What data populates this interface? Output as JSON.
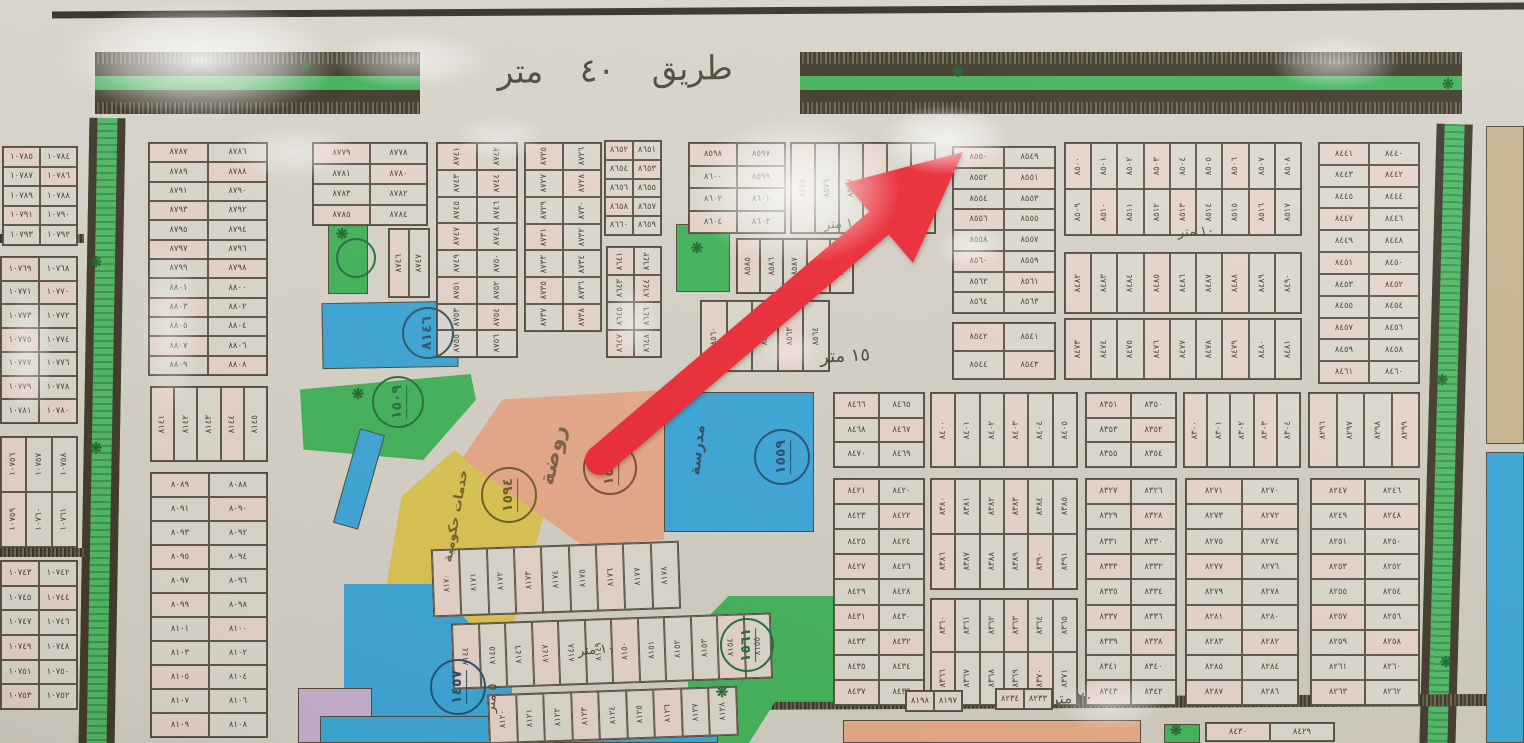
{
  "numerals": "٠١٢٣٤٥٦٧٨٩",
  "colors": {
    "green": "#3cb257",
    "blue": "#35a5da",
    "yellow": "#dcc44e",
    "salmon": "#e7a887",
    "lavender": "#c5afd2",
    "tan": "#c6b28c",
    "arrow_red": "#ee2431",
    "ink": "#4a4335",
    "paper": "#d7d3ca"
  },
  "roads": {
    "top_label": "طريق ٤٠ متر"
  },
  "street_labels": [
    {
      "text": "١٥ متر",
      "x": 845,
      "y": 356,
      "size": 18,
      "rot": -3
    },
    {
      "text": "١٠ متر",
      "x": 842,
      "y": 224,
      "size": 13,
      "rot": -4
    },
    {
      "text": "١٠ متر",
      "x": 652,
      "y": 422,
      "size": 13,
      "rot": -8
    },
    {
      "text": "١٠ متر",
      "x": 596,
      "y": 650,
      "size": 13,
      "rot": -5
    },
    {
      "text": "١٠ متر",
      "x": 1196,
      "y": 232,
      "size": 13,
      "rot": -3
    },
    {
      "text": "٢٠ متر",
      "x": 1072,
      "y": 698,
      "size": 15,
      "rot": -3
    },
    {
      "text": "٥ متر",
      "x": 492,
      "y": 698,
      "size": 13,
      "rot": -85
    }
  ],
  "zone_labels": [
    {
      "text": "روضة",
      "x": 553,
      "y": 455,
      "rot": -78,
      "size": 22,
      "color": "#6b5138"
    },
    {
      "text": "مدرسة",
      "x": 697,
      "y": 450,
      "rot": -84,
      "size": 15,
      "color": "#2a3c48"
    },
    {
      "text": "خدمات حكومية",
      "x": 456,
      "y": 516,
      "rot": -80,
      "size": 13,
      "color": "#5d4c28"
    }
  ],
  "zones": [
    {
      "id": "garden-small-left",
      "color": "green",
      "x": 328,
      "y": 224,
      "w": 40,
      "h": 70
    },
    {
      "id": "school-strip-left",
      "color": "blue",
      "x": 322,
      "y": 302,
      "w": 136,
      "h": 66,
      "rot": -1
    },
    {
      "id": "garden-triangle",
      "color": "green",
      "x": 300,
      "y": 374,
      "w": 176,
      "h": 86,
      "clip": "polygon(0 18%,97% 0,100% 30%,70% 100%,2% 88%)"
    },
    {
      "id": "blue-sliver",
      "color": "blue",
      "x": 346,
      "y": 430,
      "w": 26,
      "h": 98,
      "rot": 16
    },
    {
      "id": "services-yellow",
      "color": "yellow",
      "x": 384,
      "y": 450,
      "w": 160,
      "h": 272,
      "clip": "polygon(44% 0,100% 24%,83% 60%,52% 100%,17% 92%,0 55%,11% 17%)"
    },
    {
      "id": "kindergarten",
      "color": "salmon",
      "x": 462,
      "y": 390,
      "w": 202,
      "h": 156,
      "clip": "polygon(20% 6%,100% 0,100% 96%,60% 100%,0 44%)"
    },
    {
      "id": "school-main",
      "color": "blue",
      "x": 664,
      "y": 392,
      "w": 150,
      "h": 140
    },
    {
      "id": "school-lower-left",
      "color": "blue",
      "x": 344,
      "y": 584,
      "w": 168,
      "h": 159,
      "clip": "polygon(0 0,52% 0,100% 52%,100% 100%,28% 100%,0 68%)"
    },
    {
      "id": "lavender-corner",
      "color": "lavender",
      "x": 298,
      "y": 688,
      "w": 74,
      "h": 55
    },
    {
      "id": "garden-mid-bottom",
      "color": "green",
      "x": 688,
      "y": 596,
      "w": 145,
      "h": 147,
      "clip": "polygon(28% 0,100% 0,100% 72%,60% 72%,42% 100%,10% 100%,0 80%,0 28%)"
    },
    {
      "id": "garden-small-top",
      "color": "green",
      "x": 676,
      "y": 224,
      "w": 54,
      "h": 68
    },
    {
      "id": "tan-right-edge",
      "color": "tan",
      "x": 1486,
      "y": 126,
      "w": 38,
      "h": 318
    },
    {
      "id": "blue-right-edge",
      "color": "blue",
      "x": 1486,
      "y": 452,
      "w": 38,
      "h": 291
    },
    {
      "id": "blue-bottom-strip",
      "color": "blue",
      "x": 320,
      "y": 716,
      "w": 398,
      "h": 27
    },
    {
      "id": "salmon-bottom-strip",
      "color": "salmon",
      "x": 843,
      "y": 720,
      "w": 298,
      "h": 23
    },
    {
      "id": "green-bottom-square",
      "color": "green",
      "x": 1164,
      "y": 724,
      "w": 36,
      "h": 19
    }
  ],
  "circles": [
    {
      "value": "٨١٤٦",
      "x": 428,
      "y": 333,
      "d": 52,
      "ink": "#27526b"
    },
    {
      "value": "١٥٠٩",
      "x": 398,
      "y": 402,
      "d": 52,
      "ink": "#1e6b38"
    },
    {
      "value": "١٥٩٤",
      "x": 509,
      "y": 495,
      "d": 56,
      "ink": "#6b5a1e"
    },
    {
      "value": "١٥٥٤",
      "x": 610,
      "y": 468,
      "d": 54,
      "ink": "#7a4a2e"
    },
    {
      "value": "١٥٥٩",
      "x": 782,
      "y": 457,
      "d": 56,
      "ink": "#1d4d72"
    },
    {
      "value": "١٤٥٧",
      "x": 458,
      "y": 687,
      "d": 56,
      "ink": "#1d4d72"
    },
    {
      "value": "١٥٦١",
      "x": 747,
      "y": 645,
      "d": 54,
      "ink": "#1e6b38"
    },
    {
      "value": "",
      "x": 356,
      "y": 258,
      "d": 40,
      "ink": "#1e6b38"
    }
  ],
  "sparkles": [
    {
      "x": 306,
      "y": 66
    },
    {
      "x": 958,
      "y": 72
    },
    {
      "x": 1448,
      "y": 84
    },
    {
      "x": 96,
      "y": 262
    },
    {
      "x": 96,
      "y": 448
    },
    {
      "x": 342,
      "y": 234
    },
    {
      "x": 697,
      "y": 248
    },
    {
      "x": 722,
      "y": 692
    },
    {
      "x": 1442,
      "y": 380
    },
    {
      "x": 1446,
      "y": 662
    },
    {
      "x": 358,
      "y": 394
    },
    {
      "x": 1176,
      "y": 730
    }
  ],
  "blocks": [
    {
      "x": 2,
      "y": 146,
      "w": 76,
      "h": 100,
      "c": 2,
      "r": 5,
      "s": 10784,
      "o": "h"
    },
    {
      "x": 0,
      "y": 256,
      "w": 78,
      "h": 168,
      "c": 2,
      "r": 7,
      "s": 10768,
      "o": "h"
    },
    {
      "x": 0,
      "y": 436,
      "w": 78,
      "h": 112,
      "c": 3,
      "r": 2,
      "s": 10756,
      "o": "v"
    },
    {
      "x": 0,
      "y": 560,
      "w": 78,
      "h": 150,
      "c": 2,
      "r": 6,
      "s": 10742,
      "o": "h"
    },
    {
      "x": 148,
      "y": 142,
      "w": 120,
      "h": 234,
      "c": 2,
      "r": 12,
      "s": 8786,
      "o": "h"
    },
    {
      "x": 150,
      "y": 386,
      "w": 118,
      "h": 76,
      "c": 5,
      "r": 1,
      "s": 8141,
      "o": "v"
    },
    {
      "x": 150,
      "y": 472,
      "w": 118,
      "h": 266,
      "c": 2,
      "r": 11,
      "s": 8088,
      "o": "h"
    },
    {
      "x": 312,
      "y": 142,
      "w": 116,
      "h": 84,
      "c": 2,
      "r": 4,
      "s": 8778,
      "o": "h"
    },
    {
      "x": 388,
      "y": 228,
      "w": 42,
      "h": 70,
      "c": 2,
      "r": 1,
      "s": 8746,
      "o": "v"
    },
    {
      "x": 436,
      "y": 142,
      "w": 82,
      "h": 216,
      "c": 2,
      "r": 8,
      "s": 8741,
      "o": "v"
    },
    {
      "x": 524,
      "y": 142,
      "w": 78,
      "h": 190,
      "c": 2,
      "r": 7,
      "s": 8725,
      "o": "v"
    },
    {
      "x": 604,
      "y": 140,
      "w": 58,
      "h": 96,
      "c": 2,
      "r": 5,
      "s": 8651,
      "o": "h"
    },
    {
      "x": 606,
      "y": 246,
      "w": 56,
      "h": 112,
      "c": 2,
      "r": 4,
      "s": 8641,
      "o": "v"
    },
    {
      "x": 688,
      "y": 142,
      "w": 98,
      "h": 92,
      "c": 2,
      "r": 4,
      "s": 8597,
      "o": "h"
    },
    {
      "x": 736,
      "y": 238,
      "w": 118,
      "h": 56,
      "c": 5,
      "r": 1,
      "s": 8585,
      "o": "v"
    },
    {
      "x": 790,
      "y": 142,
      "w": 146,
      "h": 92,
      "c": 6,
      "r": 1,
      "s": 8575,
      "o": "v"
    },
    {
      "x": 700,
      "y": 300,
      "w": 130,
      "h": 72,
      "c": 5,
      "r": 1,
      "s": 8560,
      "o": "v"
    },
    {
      "x": 952,
      "y": 146,
      "w": 104,
      "h": 168,
      "c": 2,
      "r": 8,
      "s": 8549,
      "o": "h"
    },
    {
      "x": 952,
      "y": 322,
      "w": 104,
      "h": 58,
      "c": 2,
      "r": 2,
      "s": 8541,
      "o": "h"
    },
    {
      "x": 1064,
      "y": 142,
      "w": 238,
      "h": 94,
      "c": 9,
      "r": 2,
      "s": 8500,
      "o": "v"
    },
    {
      "x": 1064,
      "y": 252,
      "w": 238,
      "h": 62,
      "c": 9,
      "r": 1,
      "s": 8482,
      "o": "v"
    },
    {
      "x": 1064,
      "y": 318,
      "w": 238,
      "h": 62,
      "c": 9,
      "r": 1,
      "s": 8473,
      "o": "v"
    },
    {
      "x": 1318,
      "y": 142,
      "w": 102,
      "h": 242,
      "c": 2,
      "r": 11,
      "s": 8440,
      "o": "h"
    },
    {
      "x": 833,
      "y": 392,
      "w": 92,
      "h": 76,
      "c": 2,
      "r": 3,
      "s": 8465,
      "o": "h"
    },
    {
      "x": 833,
      "y": 478,
      "w": 92,
      "h": 228,
      "c": 2,
      "r": 9,
      "s": 8420,
      "o": "h"
    },
    {
      "x": 930,
      "y": 392,
      "w": 148,
      "h": 76,
      "c": 6,
      "r": 1,
      "s": 8400,
      "o": "v"
    },
    {
      "x": 930,
      "y": 478,
      "w": 148,
      "h": 112,
      "c": 6,
      "r": 2,
      "s": 8380,
      "o": "v"
    },
    {
      "x": 930,
      "y": 598,
      "w": 148,
      "h": 108,
      "c": 6,
      "r": 2,
      "s": 8360,
      "o": "v"
    },
    {
      "x": 1085,
      "y": 392,
      "w": 92,
      "h": 76,
      "c": 2,
      "r": 3,
      "s": 8350,
      "o": "h"
    },
    {
      "x": 1085,
      "y": 478,
      "w": 92,
      "h": 228,
      "c": 2,
      "r": 9,
      "s": 8326,
      "o": "h"
    },
    {
      "x": 1183,
      "y": 392,
      "w": 118,
      "h": 76,
      "c": 5,
      "r": 1,
      "s": 8300,
      "o": "v"
    },
    {
      "x": 1185,
      "y": 478,
      "w": 114,
      "h": 228,
      "c": 2,
      "r": 9,
      "s": 8270,
      "o": "h"
    },
    {
      "x": 1308,
      "y": 392,
      "w": 112,
      "h": 76,
      "c": 4,
      "r": 1,
      "s": 8296,
      "o": "v"
    },
    {
      "x": 1310,
      "y": 478,
      "w": 110,
      "h": 228,
      "c": 2,
      "r": 9,
      "s": 8246,
      "o": "h"
    },
    {
      "x": 432,
      "y": 545,
      "w": 248,
      "h": 68,
      "c": 9,
      "r": 1,
      "s": 8170,
      "o": "v",
      "rot": -2
    },
    {
      "x": 452,
      "y": 618,
      "w": 320,
      "h": 66,
      "c": 12,
      "r": 1,
      "s": 8144,
      "o": "v",
      "rot": -2
    },
    {
      "x": 488,
      "y": 690,
      "w": 250,
      "h": 50,
      "c": 9,
      "r": 1,
      "s": 8120,
      "o": "v",
      "rot": -2
    },
    {
      "x": 905,
      "y": 690,
      "w": 58,
      "h": 22,
      "c": 2,
      "r": 1,
      "s": 8197,
      "o": "h"
    },
    {
      "x": 995,
      "y": 688,
      "w": 58,
      "h": 22,
      "c": 2,
      "r": 1,
      "s": 8233,
      "o": "h"
    },
    {
      "x": 1205,
      "y": 722,
      "w": 130,
      "h": 20,
      "c": 2,
      "r": 1,
      "s": 8429,
      "o": "h"
    }
  ],
  "glares": [
    {
      "x": 60,
      "y": 0,
      "w": 280,
      "h": 120,
      "op": 0.95
    },
    {
      "x": 330,
      "y": 30,
      "w": 160,
      "h": 60,
      "op": 0.6
    },
    {
      "x": 690,
      "y": 115,
      "w": 210,
      "h": 150,
      "op": 0.9
    },
    {
      "x": 880,
      "y": 105,
      "w": 130,
      "h": 70,
      "op": 0.8
    },
    {
      "x": 935,
      "y": 225,
      "w": 70,
      "h": 45,
      "op": 0.55
    },
    {
      "x": 605,
      "y": 285,
      "w": 55,
      "h": 75,
      "op": 0.5
    },
    {
      "x": 1270,
      "y": 35,
      "w": 130,
      "h": 55,
      "op": 0.55
    },
    {
      "x": 140,
      "y": 240,
      "w": 60,
      "h": 180,
      "op": 0.45
    },
    {
      "x": 0,
      "y": 290,
      "w": 55,
      "h": 130,
      "op": 0.5
    },
    {
      "x": 455,
      "y": 115,
      "w": 90,
      "h": 45,
      "op": 0.45
    },
    {
      "x": 1055,
      "y": 680,
      "w": 110,
      "h": 50,
      "op": 0.5
    },
    {
      "x": 230,
      "y": 125,
      "w": 130,
      "h": 55,
      "op": 0.5
    },
    {
      "x": 760,
      "y": 330,
      "w": 60,
      "h": 40,
      "op": 0.4
    }
  ]
}
